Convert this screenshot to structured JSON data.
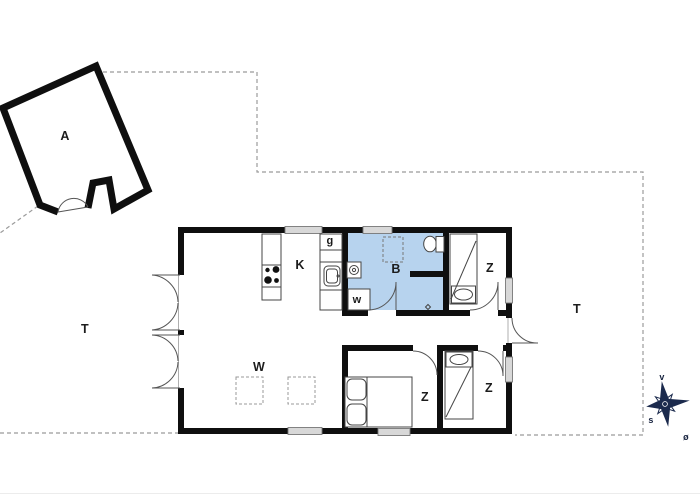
{
  "floor_plan": {
    "annex": {
      "label": "A"
    },
    "kitchen": {
      "label": "K"
    },
    "wardrobe": {
      "label": "g"
    },
    "bathroom": {
      "label": "B"
    },
    "utility": {
      "label": "w"
    },
    "bedroom_top_right": {
      "label": "Z"
    },
    "bedroom_bottom_middle": {
      "label": "Z"
    },
    "bedroom_bottom_right": {
      "label": "Z"
    },
    "living_room": {
      "label": "W"
    },
    "terrace_left": {
      "label": "T"
    },
    "terrace_right": {
      "label": "T"
    },
    "compass": {
      "west": "v",
      "south": "s",
      "east": "ø"
    },
    "colors": {
      "wall": "#0f0f0f",
      "bathroom_fill": "#b7d3ee",
      "window_fill": "#d8d8d8",
      "boundary_line": "#9b9b9b",
      "fixture_line": "#444444",
      "door_line": "#555555",
      "compass": "#1b2a4d"
    }
  }
}
